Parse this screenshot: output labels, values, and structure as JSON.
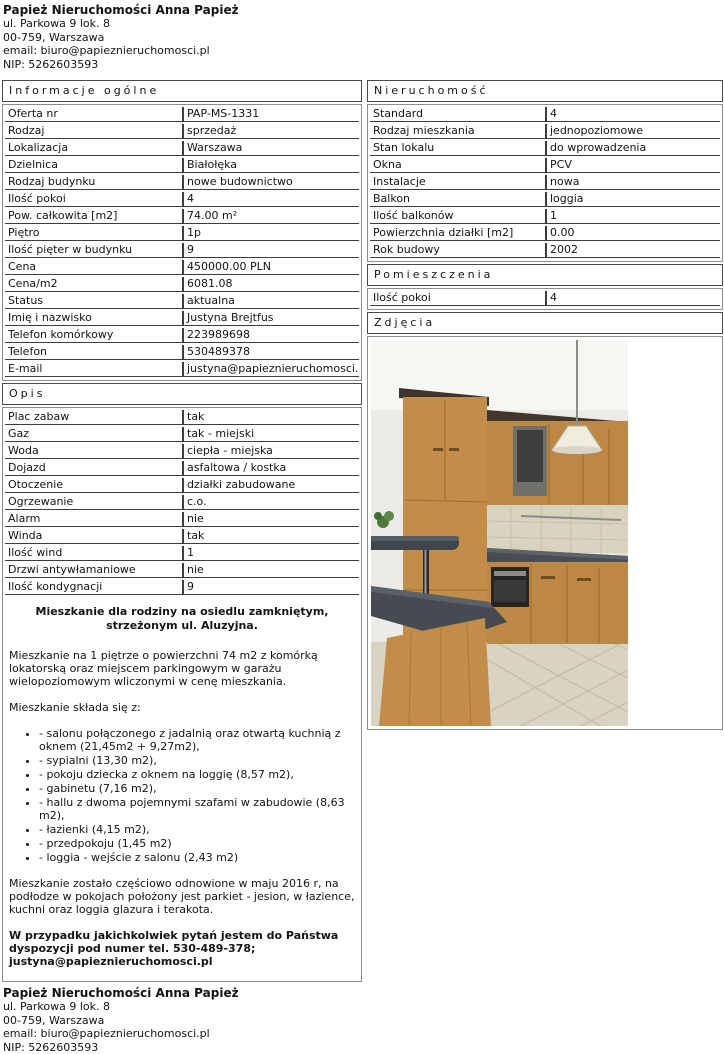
{
  "colors": {
    "text": "#141414",
    "row_border": "#3c3c3c",
    "frame_border": "#8c8c8c",
    "header_border": "#4a4a4a",
    "page_bg": "#ffffff"
  },
  "agency": {
    "name": "Papież Nieruchomości Anna Papież",
    "address": "ul. Parkowa 9 lok. 8",
    "city": "00-759, Warszawa",
    "email": "email: biuro@papieznieruchomosci.pl",
    "nip": "NIP: 5262603593"
  },
  "sections": {
    "informacje": {
      "title": "Informacje ogólne",
      "rows": [
        {
          "label": "Oferta nr",
          "value": "PAP-MS-1331"
        },
        {
          "label": "Rodzaj",
          "value": "sprzedaż"
        },
        {
          "label": "Lokalizacja",
          "value": "Warszawa"
        },
        {
          "label": "Dzielnica",
          "value": "Białołęka"
        },
        {
          "label": "Rodzaj budynku",
          "value": "nowe budownictwo"
        },
        {
          "label": "Ilość pokoi",
          "value": "4"
        },
        {
          "label": "Pow. całkowita [m2]",
          "value": "74.00 m²"
        },
        {
          "label": "Piętro",
          "value": "1p"
        },
        {
          "label": "Ilość pięter w budynku",
          "value": "9"
        },
        {
          "label": "Cena",
          "value": "450000.00 PLN"
        },
        {
          "label": "Cena/m2",
          "value": "6081.08"
        },
        {
          "label": "Status",
          "value": "aktualna"
        },
        {
          "label": "Imię i nazwisko",
          "value": "Justyna Brejtfus"
        },
        {
          "label": "Telefon komórkowy",
          "value": "223989698"
        },
        {
          "label": "Telefon",
          "value": "530489378"
        },
        {
          "label": "E-mail",
          "value": "justyna@papieznieruchomosci.pl"
        }
      ]
    },
    "nieruchomosc": {
      "title": "Nieruchomość",
      "rows": [
        {
          "label": "Standard",
          "value": "4"
        },
        {
          "label": "Rodzaj mieszkania",
          "value": "jednopoziomowe"
        },
        {
          "label": "Stan lokalu",
          "value": "do wprowadzenia"
        },
        {
          "label": "Okna",
          "value": "PCV"
        },
        {
          "label": "Instalacje",
          "value": "nowa"
        },
        {
          "label": "Balkon",
          "value": "loggia"
        },
        {
          "label": "Ilość balkonów",
          "value": "1"
        },
        {
          "label": "Powierzchnia działki [m2]",
          "value": "0.00"
        },
        {
          "label": "Rok budowy",
          "value": "2002"
        }
      ]
    },
    "pomieszczenia": {
      "title": "Pomieszczenia",
      "rows": [
        {
          "label": "Ilość pokoi",
          "value": "4"
        }
      ]
    },
    "zdjecia": {
      "title": "Zdjęcia",
      "photo_description": "kitchen with light wood cabinets, dark grey worktops, breakfast bar, pendant lamp and beige tiled floor"
    },
    "opis": {
      "title": "Opis",
      "rows": [
        {
          "label": "Plac zabaw",
          "value": "tak"
        },
        {
          "label": "Gaz",
          "value": "tak - miejski"
        },
        {
          "label": "Woda",
          "value": "ciepła - miejska"
        },
        {
          "label": "Dojazd",
          "value": "asfaltowa / kostka"
        },
        {
          "label": "Otoczenie",
          "value": "działki zabudowane"
        },
        {
          "label": "Ogrzewanie",
          "value": "c.o."
        },
        {
          "label": "Alarm",
          "value": "nie"
        },
        {
          "label": "Winda",
          "value": "tak"
        },
        {
          "label": "Ilość wind",
          "value": "1"
        },
        {
          "label": "Drzwi antywłamaniowe",
          "value": "nie"
        },
        {
          "label": "Ilość kondygnacji",
          "value": "9"
        }
      ],
      "description": {
        "heading": "Mieszkanie dla rodziny na osiedlu zamkniętym, strzeżonym ul. Aluzyjna.",
        "intro": "Mieszkanie na 1 piętrze o powierzchni 74 m2 z komórką lokatorską oraz miejscem parkingowym w garażu wielopoziomowym wliczonymi w cenę mieszkania.",
        "list_intro": "Mieszkanie składa się z:",
        "bullets": [
          "- salonu połączonego z jadalnią oraz otwartą kuchnią z oknem (21,45m2 + 9,27m2),",
          "- sypialni (13,30 m2),",
          "- pokoju dziecka z oknem na loggię (8,57 m2),",
          "- gabinetu (7,16 m2),",
          "- hallu z dwoma pojemnymi szafami w zabudowie (8,63 m2),",
          "- łazienki (4,15 m2),",
          "- przedpokoju (1,45 m2)",
          "- loggia - wejście z salonu (2,43 m2)"
        ],
        "renovation": "Mieszkanie zostało częściowo odnowione w maju 2016 r, na podłodze w pokojach położony jest parkiet - jesion, w łazience, kuchni oraz loggia glazura i terakota.",
        "contact": "W przypadku jakichkolwiek pytań jestem do Państwa dyspozycji pod numer tel. 530-489-378; justyna@papieznieruchomosci.pl"
      }
    }
  },
  "footer": {
    "name": "Papież Nieruchomości Anna Papież",
    "address": "ul. Parkowa 9 lok. 8",
    "city": "00-759, Warszawa",
    "email": "email: biuro@papieznieruchomosci.pl",
    "nip": "NIP: 5262603593"
  }
}
